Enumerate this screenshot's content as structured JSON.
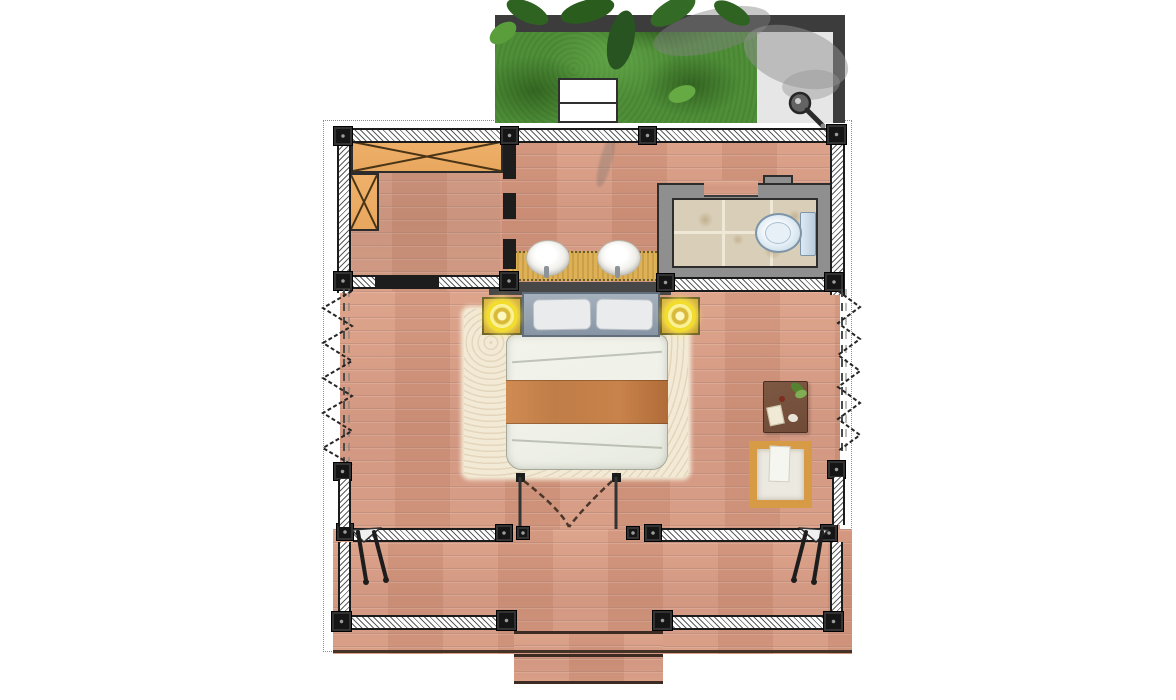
{
  "scene": {
    "type": "floor-plan",
    "description": "overhead architectural floor plan of a one-room garden villa",
    "regions": {
      "garden": {
        "label": "garden terrace",
        "features": [
          "grass-lawn",
          "leaf-canopy",
          "outdoor-shower-pad",
          "garden-bench"
        ]
      },
      "closet": {
        "label": "walk-in closet",
        "features": [
          "wardrobe-top",
          "wardrobe-side"
        ]
      },
      "dressing": {
        "label": "vanity corridor",
        "features": [
          "double-sink-vanity"
        ]
      },
      "bathroom": {
        "label": "bathroom",
        "features": [
          "tiled-floor",
          "toilet",
          "door-opening"
        ]
      },
      "bedroom": {
        "label": "bedroom",
        "features": [
          "double-bed",
          "area-rug",
          "nightstand-left",
          "nightstand-right",
          "bedside-lamp-left",
          "bedside-lamp-right",
          "writing-desk",
          "lounge-seat",
          "double-entry-door",
          "folding-doors-left",
          "folding-doors-right"
        ]
      },
      "deck": {
        "label": "veranda deck",
        "features": [
          "railing",
          "entry-steps",
          "corner-brace-left",
          "corner-brace-right"
        ]
      }
    },
    "icons": [
      "shower-head-icon",
      "lamp-icon",
      "toilet-icon",
      "sink-icon",
      "plant-icon",
      "wardrobe-x-icon",
      "door-swing-icon",
      "folding-door-zigzag-icon",
      "brace-icon"
    ]
  },
  "palette": {
    "ink": "#1b1b1b",
    "wood": "#d79b82",
    "grass": "#4f8f38",
    "band": "#3c3c3c",
    "pad": "#e6e6e6",
    "orange": "#e8a75e",
    "counter": "#ddb257",
    "tile": "#d9cfb8",
    "bathwall": "#8f8f8f",
    "toilet": "#cfe0ed",
    "headboard": "#95a1af",
    "pillow": "#e9ebed",
    "duvet": "#eff1e9",
    "blanket": "#c07d47",
    "rug": "#f3ead6",
    "gold": "#c79f35",
    "glow": "#f2dd2e",
    "desk": "#6f4b37",
    "seat": "#d69b44"
  }
}
